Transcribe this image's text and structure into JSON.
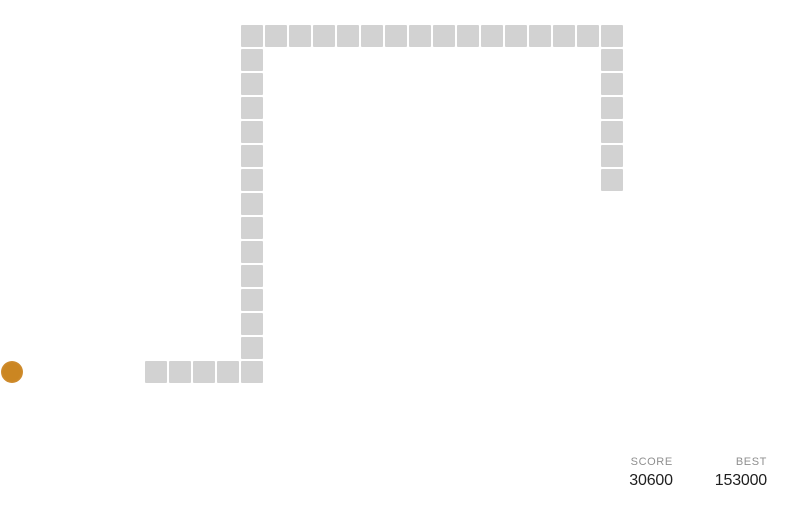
{
  "game": {
    "grid": {
      "origin_x": 1,
      "origin_y": 25,
      "cell_pitch": 24,
      "block_size": 22
    },
    "snake": {
      "color": "#d2d2d2",
      "cells": [
        [
          6,
          14
        ],
        [
          7,
          14
        ],
        [
          8,
          14
        ],
        [
          9,
          14
        ],
        [
          10,
          14
        ],
        [
          10,
          13
        ],
        [
          10,
          12
        ],
        [
          10,
          11
        ],
        [
          10,
          10
        ],
        [
          10,
          9
        ],
        [
          10,
          8
        ],
        [
          10,
          7
        ],
        [
          10,
          6
        ],
        [
          10,
          5
        ],
        [
          10,
          4
        ],
        [
          10,
          3
        ],
        [
          10,
          2
        ],
        [
          10,
          1
        ],
        [
          10,
          0
        ],
        [
          11,
          0
        ],
        [
          12,
          0
        ],
        [
          13,
          0
        ],
        [
          14,
          0
        ],
        [
          15,
          0
        ],
        [
          16,
          0
        ],
        [
          17,
          0
        ],
        [
          18,
          0
        ],
        [
          19,
          0
        ],
        [
          20,
          0
        ],
        [
          21,
          0
        ],
        [
          22,
          0
        ],
        [
          23,
          0
        ],
        [
          24,
          0
        ],
        [
          25,
          0
        ],
        [
          25,
          1
        ],
        [
          25,
          2
        ],
        [
          25,
          3
        ],
        [
          25,
          4
        ],
        [
          25,
          5
        ],
        [
          25,
          6
        ]
      ]
    },
    "food": {
      "cell": [
        0,
        14
      ],
      "color_inner": "#cb8622",
      "color_outer": "#d79a50"
    },
    "hud": {
      "score_label": "SCORE",
      "score_value": "30600",
      "best_label": "BEST",
      "best_value": "153000",
      "label_color": "#8f8f8f",
      "value_color": "#1f1f1f"
    }
  }
}
